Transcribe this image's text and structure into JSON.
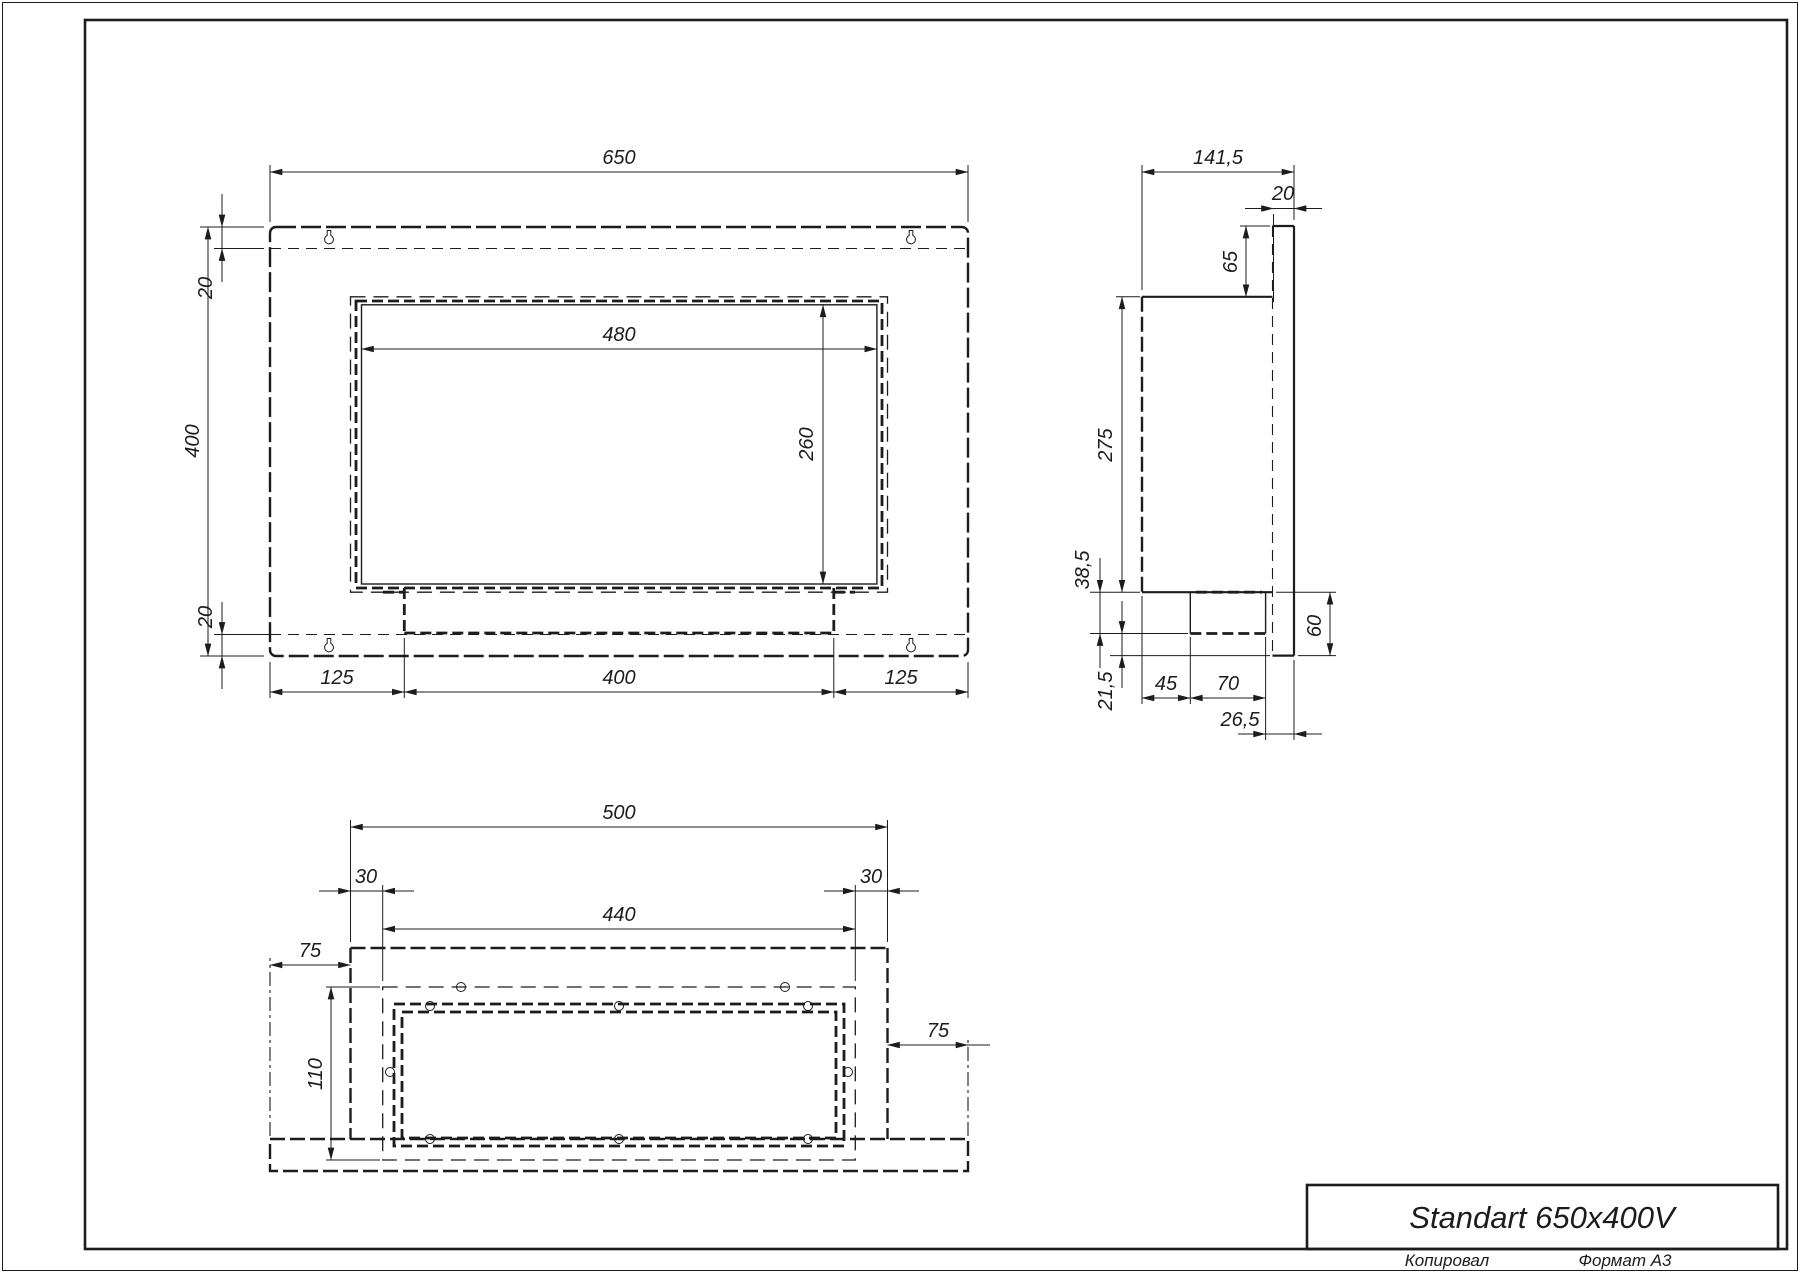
{
  "sheet": {
    "copied_label": "Копировал",
    "format_label": "Формат А3"
  },
  "title_block": {
    "title": "Standart 650x400V"
  },
  "front_view": {
    "dims": {
      "width": "650",
      "height": "400",
      "top_inset": "20",
      "bottom_inset": "20",
      "opening_width": "480",
      "opening_height": "260",
      "left_margin": "125",
      "burner_width": "400",
      "right_margin": "125"
    }
  },
  "side_view": {
    "dims": {
      "depth": "141,5",
      "frame_depth": "20",
      "top_to_box": "65",
      "box_height": "275",
      "tray_height": "38,5",
      "bottom_gap": "21,5",
      "back_offset": "45",
      "tray_depth": "70",
      "front_offset": "26,5",
      "bottom_height": "60"
    }
  },
  "bottom_view": {
    "dims": {
      "box_width": "500",
      "left_inset": "30",
      "mount_width": "440",
      "right_inset": "30",
      "left_flange": "75",
      "mount_depth": "110",
      "right_flange": "75"
    }
  },
  "colors": {
    "line": "#1c1c1c",
    "background": "#ffffff"
  }
}
